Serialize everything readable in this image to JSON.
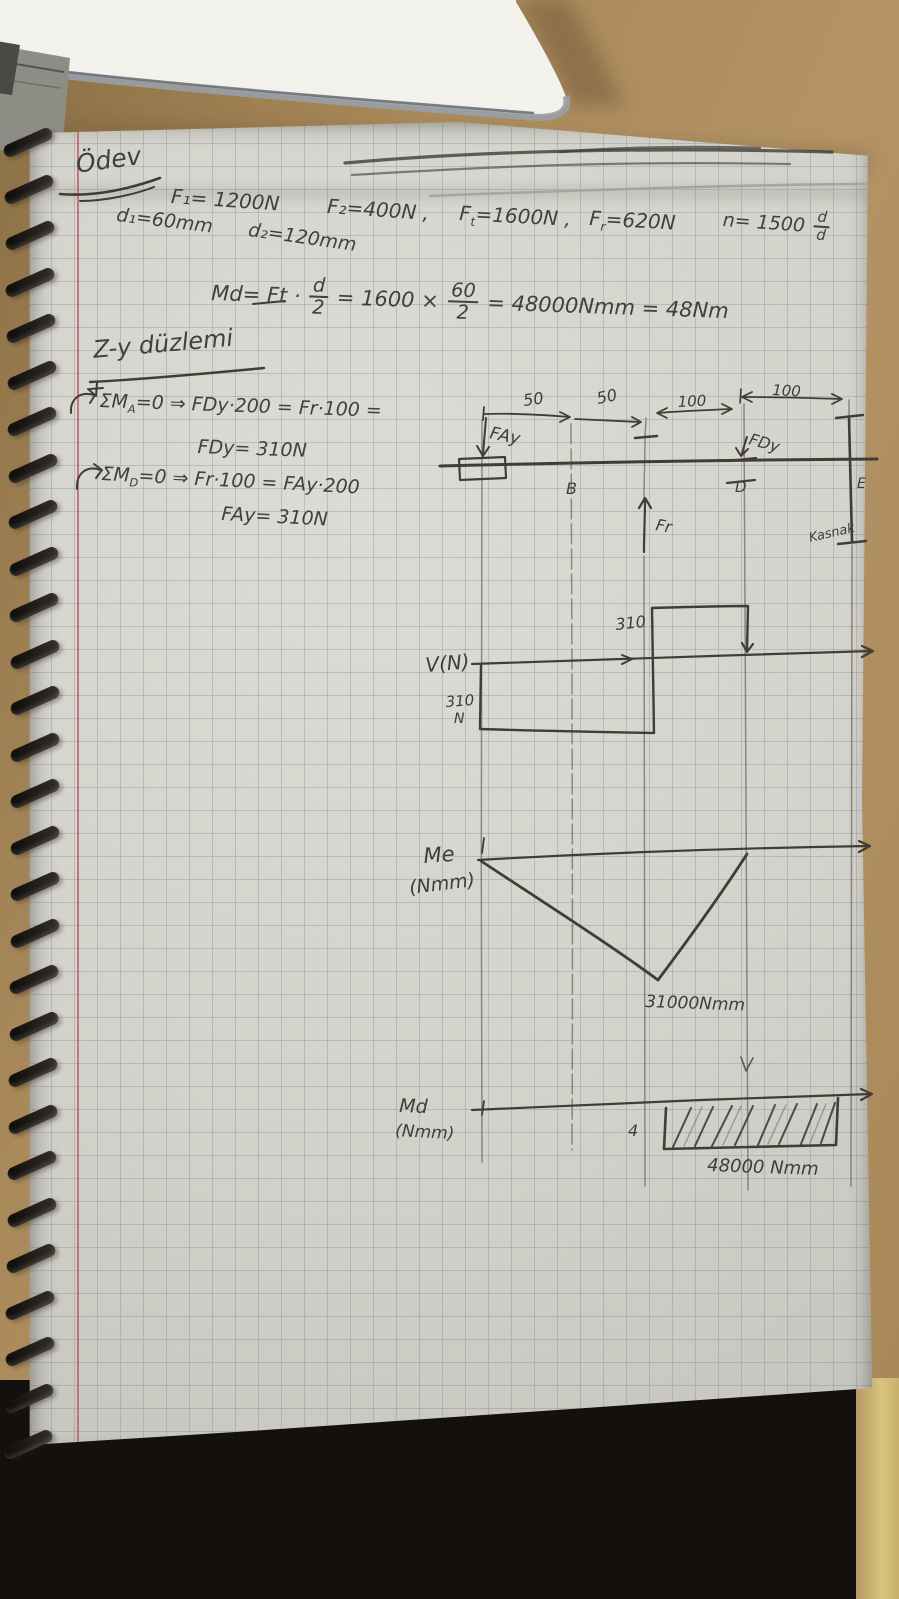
{
  "colors": {
    "desk": "#a9895a",
    "white_object": "#f2f1ec",
    "page": "#d2d1ca",
    "grid": "#7682​8c",
    "margin_line": "#c15c66",
    "ink": "#42403a",
    "lap": "#14100d",
    "jeans": "#6080ac",
    "gold_strip": "#d8c47e"
  },
  "notebook": {
    "title": "Ödev",
    "given_line": {
      "f1": "F₁= 1200N",
      "f2": "F₂=400N ,",
      "ft_pre": "F",
      "ft_sub": "t",
      "ft_post": "=1600N ,",
      "fr_pre": "F",
      "fr_sub": "r",
      "fr_post": "=620N",
      "speed_prefix": "n= 1500",
      "speed_frac_num": "d",
      "speed_frac_den": "d",
      "d1": "d₁=60mm",
      "d2": "d₂=120mm"
    },
    "md_equation": {
      "p1": "Md= Ft ·",
      "frac1_num": "d",
      "frac1_den": "2",
      "p2": "= 1600 ×",
      "frac2_num": "60",
      "frac2_den": "2",
      "p3": "= 48000Nmm = 48Nm"
    },
    "section_heading": "Z-y düzlemi",
    "moment_a": {
      "pre": "ΣM",
      "sub": "A",
      "post": "=0 ⇒ FDy·200 = Fr·100 =",
      "result": "FDy= 310N"
    },
    "moment_d": {
      "pre": "ΣM",
      "sub": "D",
      "post": "=0 ⇒ Fr·100 = FAy·200",
      "result": "FAy= 310N"
    },
    "beam": {
      "dims": [
        "50",
        "50",
        "100",
        "100"
      ],
      "left_reaction": "FAy",
      "right_reaction": "FDy",
      "point_b": "B",
      "point_d": "D",
      "point_e": "E",
      "load": "Fr",
      "pulley_note": "Kasnak"
    },
    "shear_diagram": {
      "axis_label": "V(N)",
      "positive_value": "310",
      "negative_value": "310",
      "negative_unit": "N"
    },
    "bending_diagram": {
      "axis_label_1": "Me",
      "axis_label_2": "(Nmm)",
      "peak_label": "31000Nmm"
    },
    "torque_diagram": {
      "axis_label_1": "Md",
      "axis_label_2": "(Nmm)",
      "lead_digit": "4",
      "value_label": "48000 Nmm"
    }
  },
  "chart_data": [
    {
      "type": "line",
      "title": "V(N) shear diagram",
      "xlabel": "z (mm)",
      "ylabel": "V (N)",
      "x": [
        0,
        0,
        100,
        100,
        200,
        200,
        300
      ],
      "y": [
        0,
        -310,
        -310,
        310,
        310,
        0,
        0
      ],
      "annotations": [
        "310 N below axis from A to load point",
        "310 above axis from load point to D"
      ]
    },
    {
      "type": "line",
      "title": "Me (Nmm) bending moment diagram",
      "xlabel": "z (mm)",
      "ylabel": "Me (Nmm)",
      "x": [
        0,
        100,
        200,
        300
      ],
      "y": [
        0,
        -31000,
        0,
        0
      ],
      "annotations": [
        "peak 31000Nmm at load point"
      ]
    },
    {
      "type": "line",
      "title": "Md (Nmm) torque diagram",
      "xlabel": "z (mm)",
      "ylabel": "Md (Nmm)",
      "x": [
        0,
        100,
        100,
        300
      ],
      "y": [
        0,
        0,
        -48000,
        -48000
      ],
      "annotations": [
        "hatched block 48000 Nmm from load point to pulley end E"
      ]
    }
  ]
}
